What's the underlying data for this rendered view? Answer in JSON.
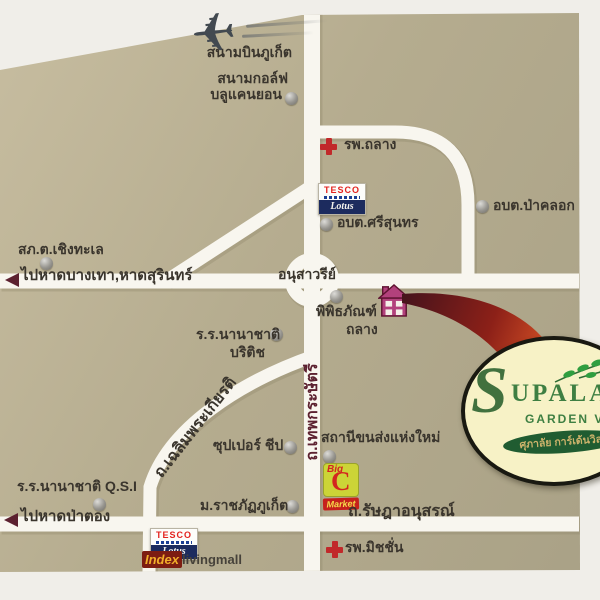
{
  "map": {
    "icons": {
      "plane": "✈"
    },
    "roads": {
      "thep": "ถ.เทพกระษัตรี",
      "chalerm": "ถ.เฉลิมพระเกียรติ",
      "rasada": "ถ.รัษฎาอนุสรณ์"
    },
    "directions": {
      "bangtao": "ไปหาดบางเทา,หาดสุรินทร์",
      "patong": "ไปหาดป่าตอง"
    },
    "landmarks": {
      "airport": "สนามบินภูเก็ต",
      "golf_line1": "สนามกอล์ฟ",
      "golf_line2": "บลูแคนยอน",
      "thalang_hospital": "รพ.ถลาง",
      "paklok": "อบต.ป่าคลอก",
      "srisoonthorn": "อบต.ศรีสุนทร",
      "cherngtalay_police": "สภ.ต.เชิงทะเล",
      "monument": "อนุสาวรีย์",
      "museum_line1": "พิพิธภัณฑ์",
      "museum_line2": "ถลาง",
      "british_school_line1": "ร.ร.นานาชาติ",
      "british_school_line2": "บริติช",
      "super_cheap": "ซุปเปอร์ ชีป",
      "bus_terminal": "สถานีขนส่งแห่งใหม่",
      "qsi_school": "ร.ร.นานาชาติ Q.S.I",
      "rajabhat_university": "ม.ราชภัฏภูเก็ต",
      "mission_hospital": "รพ.มิชชั่น"
    },
    "logos": {
      "tesco": {
        "name": "TESCO",
        "lotus": "Lotus"
      },
      "bigc": {
        "big": "Big",
        "c": "C",
        "market": "Market"
      },
      "index": {
        "brand": "Index",
        "suffix": "livingmall"
      },
      "supalai": {
        "s": "S",
        "rest": "UPALAI",
        "line2": "GARDEN VILLE",
        "thai": "ศุภาลัย การ์เด้นวิลล์"
      }
    },
    "colors": {
      "map_bg": "#b5ac8f",
      "road": "#f8f6ef",
      "label": "#3a352d",
      "maroon": "#5c2130",
      "cross_red": "#c1292a",
      "swoosh_dark": "#45131c",
      "swoosh_orange": "#e25a28",
      "logo_green": "#3e7f42",
      "logo_cream": "#f7f2c6",
      "banner_green": "#205c31",
      "house_pink": "#b2417c"
    }
  }
}
